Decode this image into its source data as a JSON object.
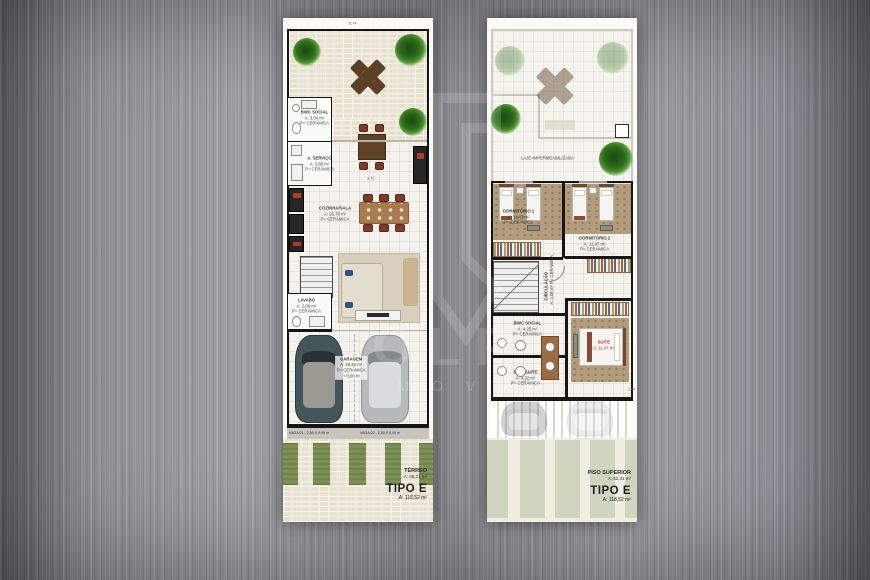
{
  "palette": {
    "background_metal": "#8f8f94",
    "plan_paper": "#fbfaf6",
    "wall": "#161616",
    "grass": "#7d9154",
    "suite_label_red": "#b03a2e",
    "plant_green": "#2f6b1c"
  },
  "watermark": {
    "letters": "OLP",
    "text": "M Ó V E I S"
  },
  "terreo": {
    "dims": {
      "top": "5,74",
      "kitchen": "3,72"
    },
    "rooms": {
      "bwc_social": {
        "name": "BWC SOCIAL",
        "area": "A: 3,04 m²",
        "floor": "P= CERÂMICA"
      },
      "servico": {
        "name": "A. SERVIÇO",
        "area": "A: 2,85 m²",
        "floor": "P= CERÂMICA"
      },
      "cozinha_sala": {
        "name": "COZINHA/SALA",
        "area": "A: 26,78 m²",
        "floor": "P= CERÂMICA"
      },
      "lavabo": {
        "name": "LAVABO",
        "area": "A: 2,06 m²",
        "floor": "P= CERÂMICA"
      },
      "garagem": {
        "name": "GARAGEM",
        "area": "A: 26,40 m²",
        "floor": "P= CERÂMICA",
        "level": "+ 0,00 m"
      }
    },
    "vagas": {
      "vaga1": "VAGA 01 - 2,50 X 5,00 m",
      "vaga2": "VAGA 02 - 2,50 X 5,00 m"
    },
    "summary": {
      "floor_name": "TÉRREO",
      "floor_area": "A: 66,21 m²",
      "type_name": "TIPO E",
      "type_area": "A: 118,52 m²"
    }
  },
  "superior": {
    "dims": {
      "bottom": "6,75",
      "right": "2,84"
    },
    "laje_label": "LAJE IMPERMEABILIZADA",
    "rooms": {
      "dormitorio1": {
        "name": "DORMITÓRIO 1",
        "area": "A: 11,43 m²",
        "floor": "P= CERÂMICA"
      },
      "dormitorio2": {
        "name": "DORMITÓRIO 2",
        "area": "A: 11,47 m²",
        "floor": "P= CERÂMICA"
      },
      "circulacao": {
        "name": "CIRCULAÇÃO",
        "area": "A: 2,08 m²",
        "floor": "P= CERÂMICA"
      },
      "bwc_social": {
        "name": "BWC SOCIAL",
        "area": "A: 4,25 m²",
        "floor": "P= CERÂMICA"
      },
      "bwc_suite": {
        "name": "BWC SUITE",
        "area": "A: 4,22 m²",
        "floor": "P= CERÂMICA"
      },
      "suite": {
        "name": "SUITE",
        "area": "A: 11,47 m²"
      }
    },
    "summary": {
      "floor_name": "PISO SUPERIOR",
      "floor_area": "A: 52,31 m²",
      "type_name": "TIPO E",
      "type_area": "A: 118,52 m²"
    }
  }
}
